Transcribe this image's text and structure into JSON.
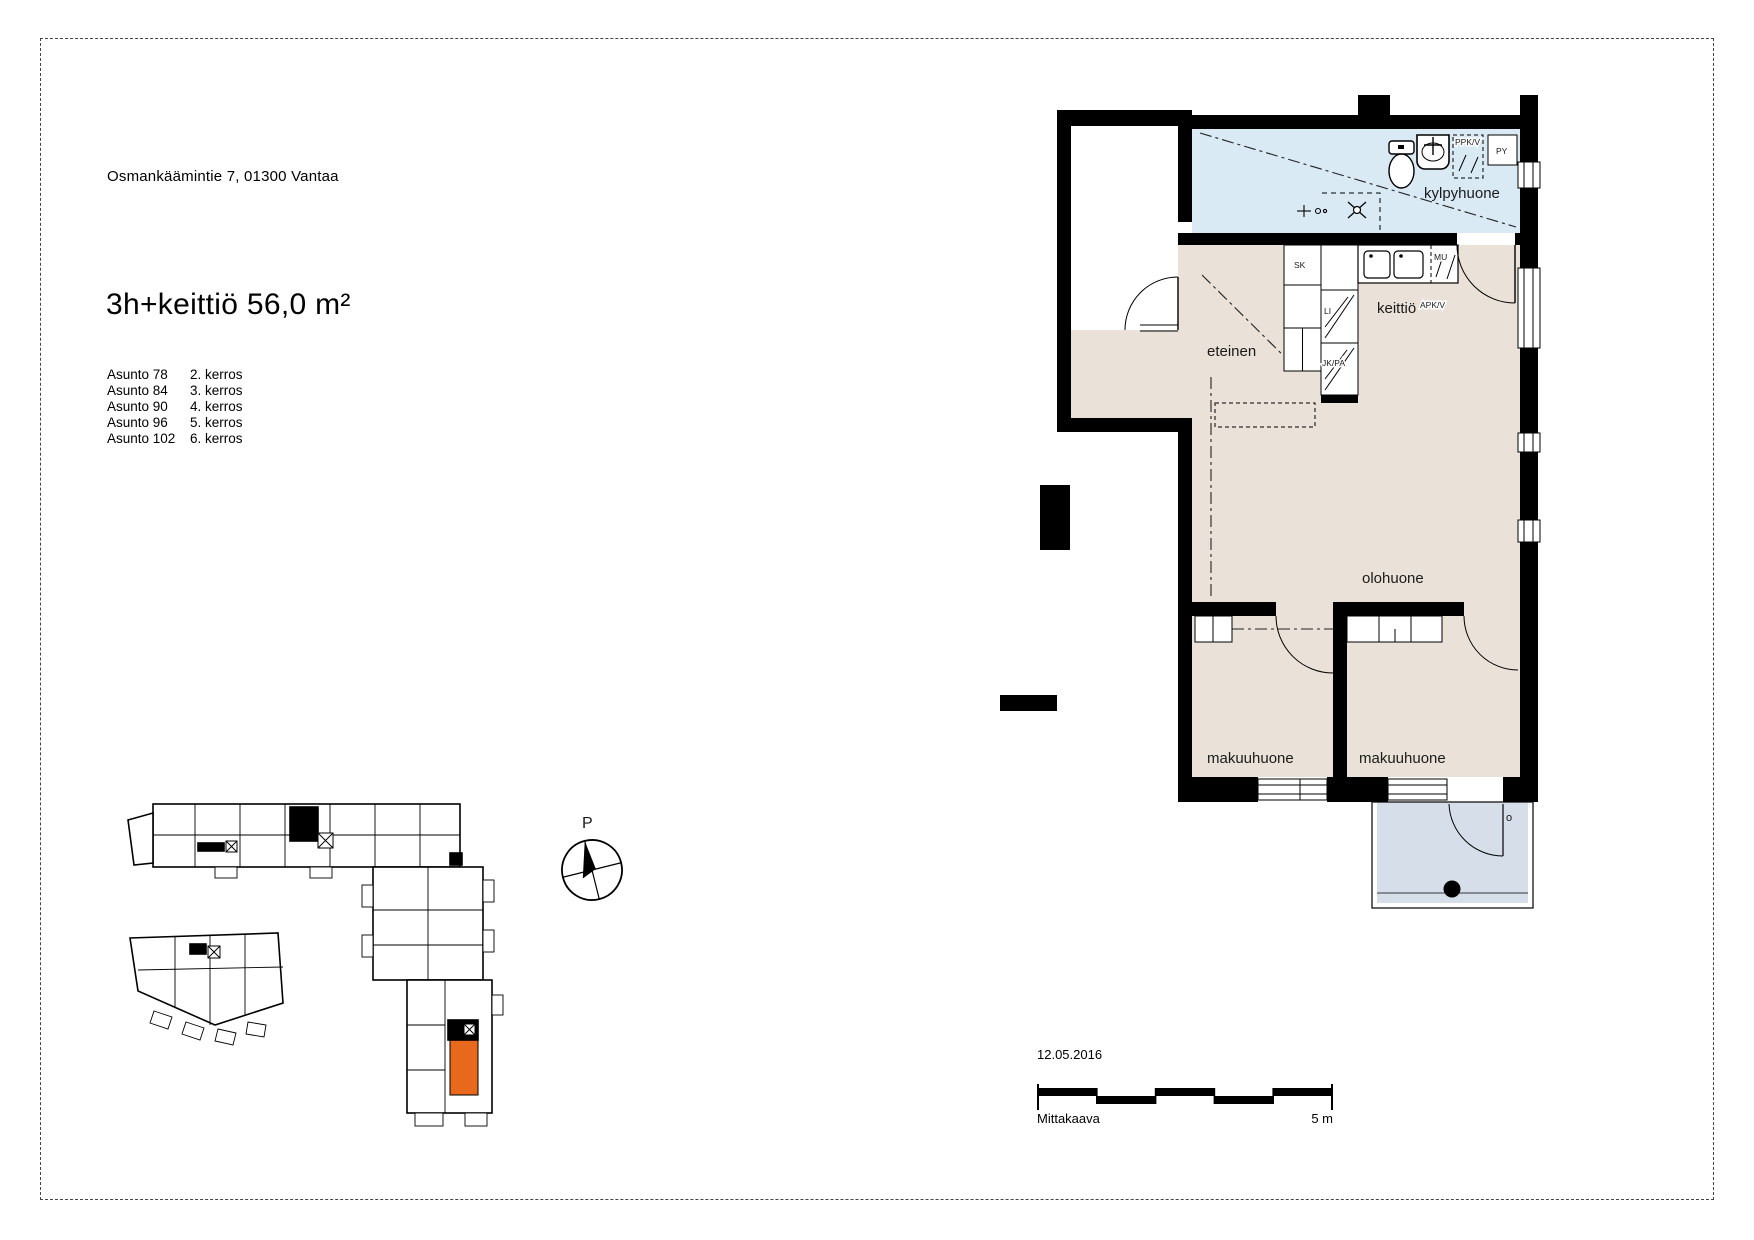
{
  "document": {
    "address": "Osmankäämintie 7,  01300 Vantaa",
    "title": "3h+keittiö  56,0 m²",
    "apartment_list": [
      {
        "apartment": "Asunto 78",
        "floor": "2. kerros"
      },
      {
        "apartment": "Asunto 84",
        "floor": "3. kerros"
      },
      {
        "apartment": "Asunto 90",
        "floor": "4. kerros"
      },
      {
        "apartment": "Asunto 96",
        "floor": "5. kerros"
      },
      {
        "apartment": "Asunto 102",
        "floor": "6. kerros"
      }
    ],
    "date": "12.05.2016",
    "scale_label": "Mittakaava",
    "scale_value": "5 m",
    "compass_label": "P"
  },
  "floor_plan": {
    "labels": {
      "kylpyhuone": "kylpyhuone",
      "keittio": "keittiö",
      "eteinen": "eteinen",
      "olohuone": "olohuone",
      "makuuhuone1": "makuuhuone",
      "makuuhuone2": "makuuhuone",
      "balcony_mark": "o"
    },
    "fixtures": {
      "sk": "SK",
      "li": "LI",
      "jkpa": "JK/PA",
      "mu": "MU",
      "apkv": "APK/V",
      "ppkv": "PPK/V",
      "py": "PY"
    },
    "colors": {
      "room_fill": "#eae2d8",
      "bathroom_fill": "#d9eaf5",
      "balcony_fill": "#d6dfe9",
      "wall": "#000000"
    }
  },
  "site_plan": {
    "highlighted_unit_color": "#e8681c"
  }
}
